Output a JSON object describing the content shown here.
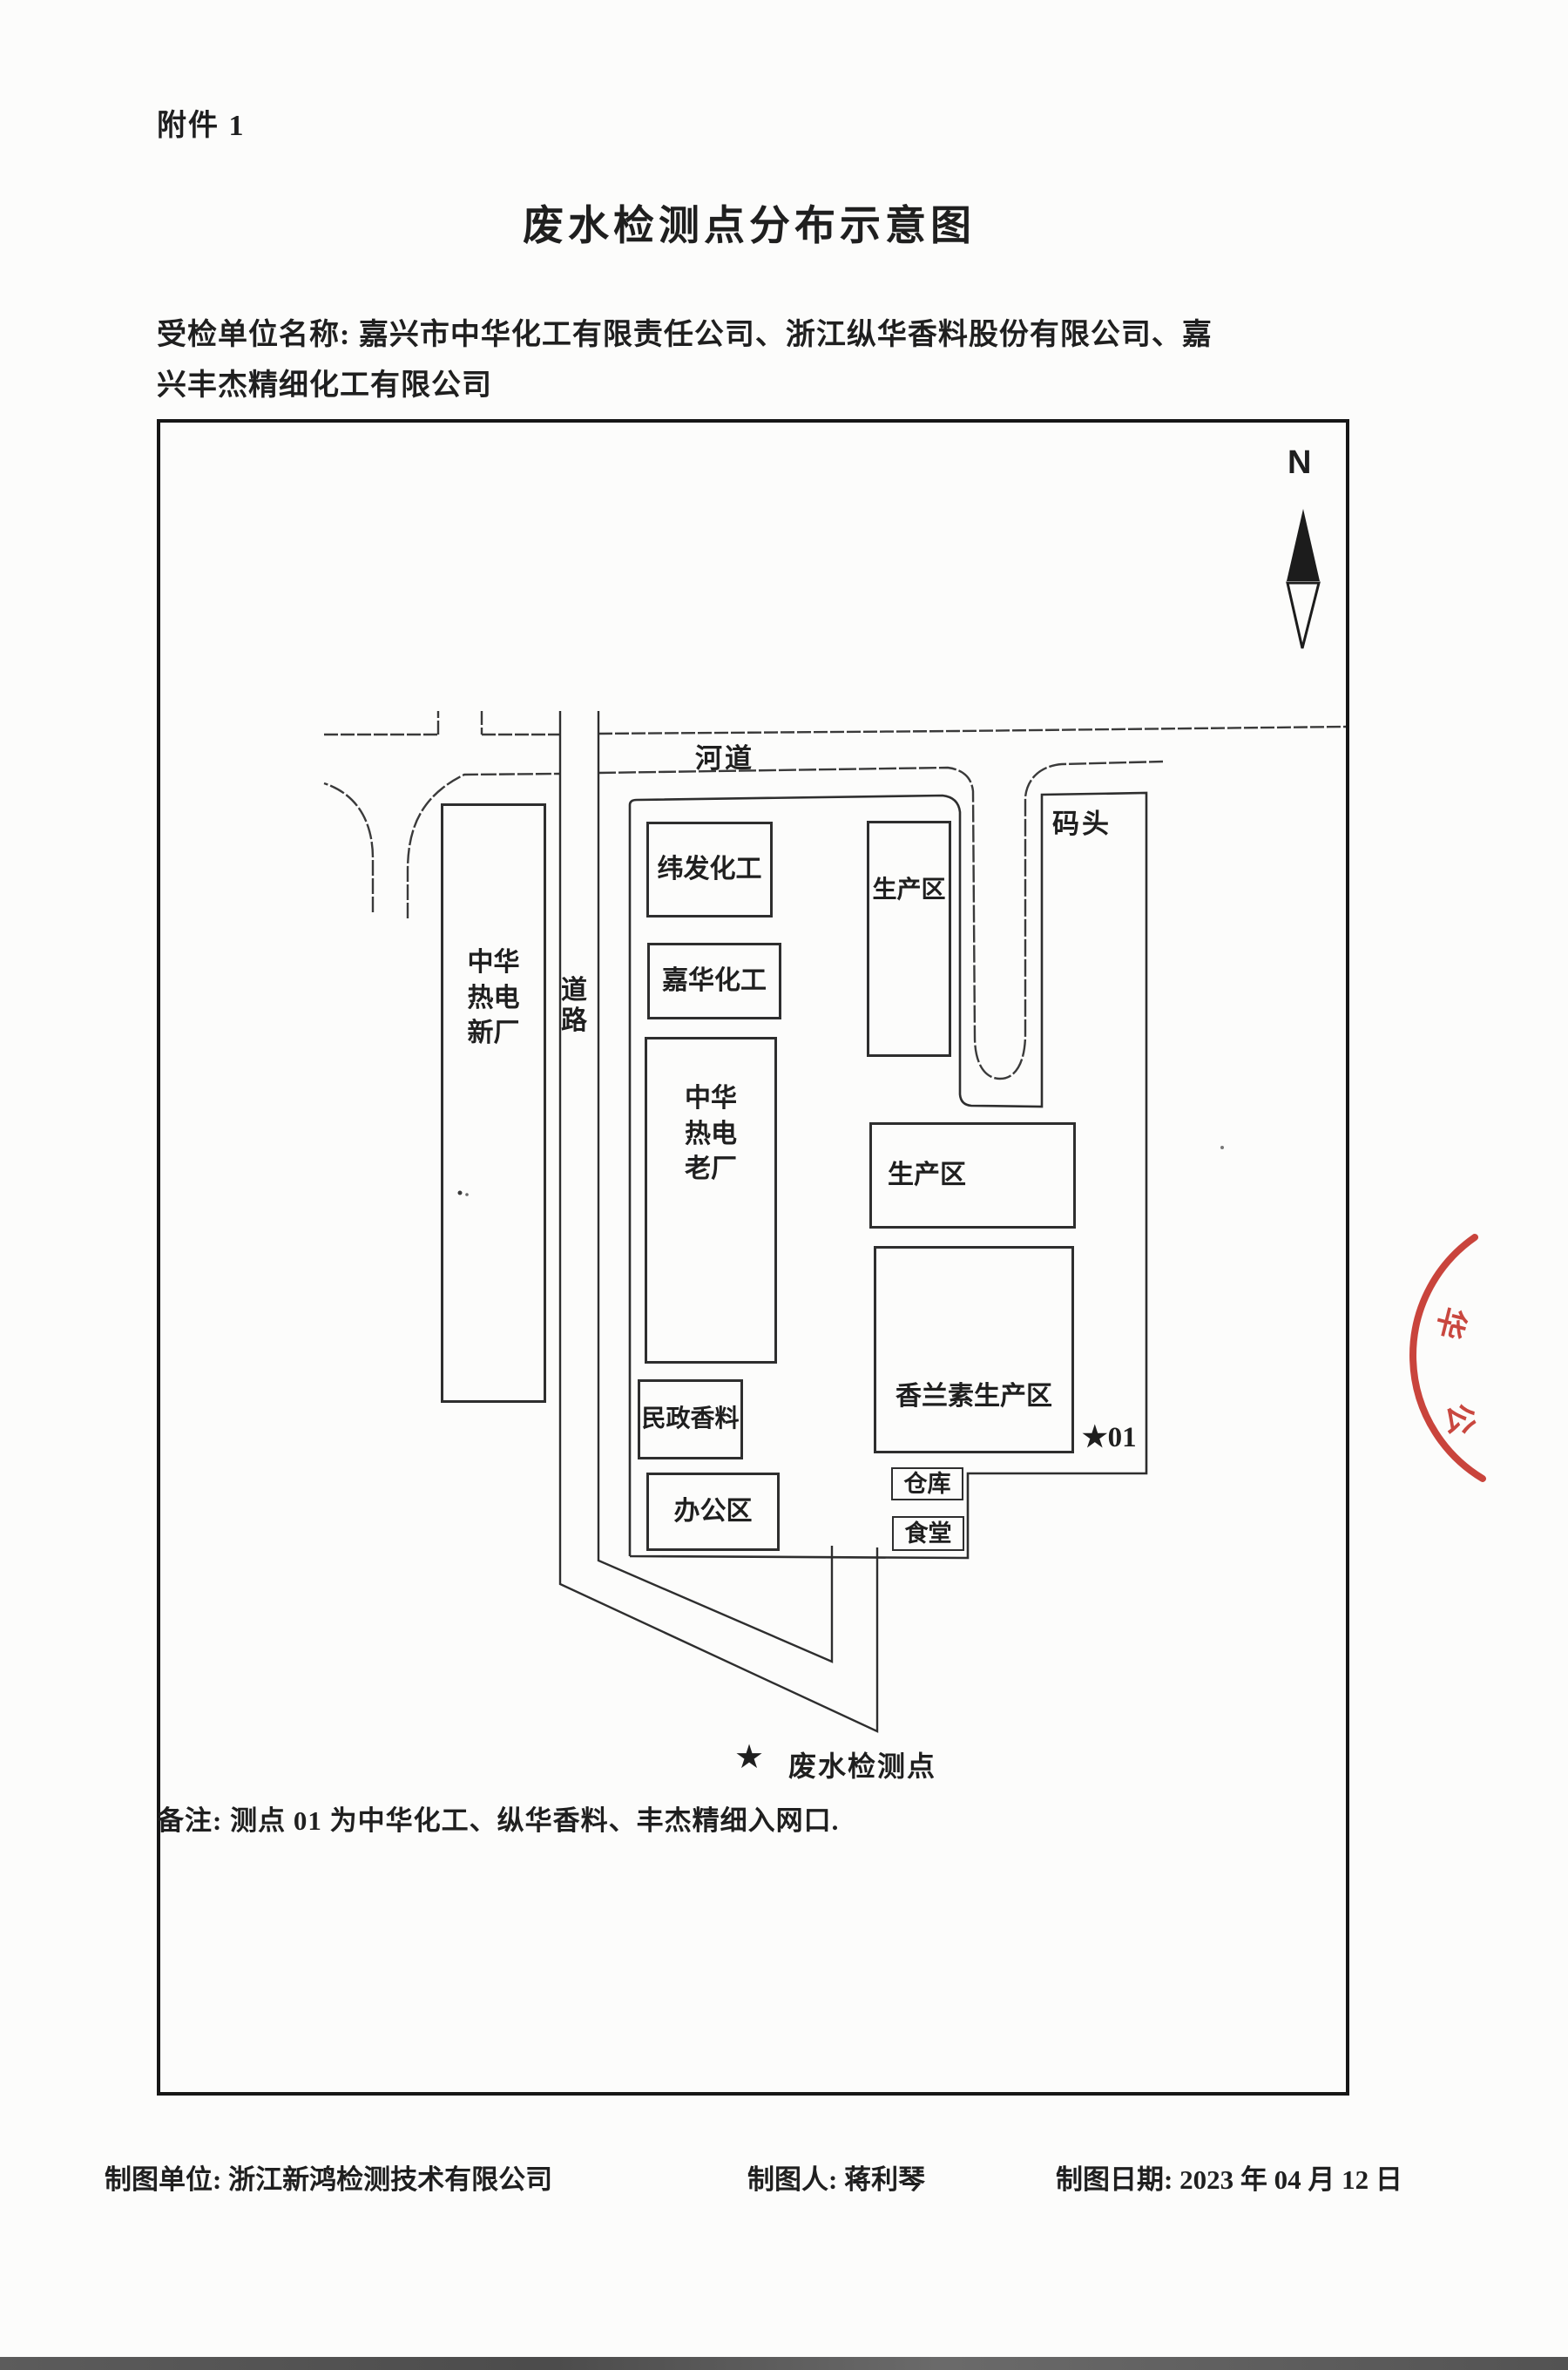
{
  "page": {
    "attachment_label": "附件 1",
    "title": "废水检测点分布示意图",
    "inspected_units_line1": "受检单位名称: 嘉兴市中华化工有限责任公司、浙江纵华香料股份有限公司、嘉",
    "inspected_units_line2": "兴丰杰精细化工有限公司"
  },
  "map": {
    "north_label": "N",
    "river_label": "河道",
    "dock_label": "码头",
    "road_label": "道路",
    "buildings": {
      "xinchang": "中华热电新厂",
      "weifa": "纬发化工",
      "jiahua": "嘉华化工",
      "laochang": "中华热电老厂",
      "minzheng": "民政香料",
      "bangong": "办公区",
      "shengchanqu_north": "生产区",
      "shengchanqu_mid": "生产区",
      "xianglansu": "香兰素生产区",
      "cangku": "仓库",
      "shitang": "食堂"
    },
    "monitoring_point": "★01",
    "legend": {
      "symbol": "★",
      "label": "废水检测点"
    },
    "note": "备注: 测点 01 为中华化工、纵华香料、丰杰精细入网口."
  },
  "footer": {
    "unit": "制图单位: 浙江新鸿检测技术有限公司",
    "drafter": "制图人: 蒋利琴",
    "date": "制图日期: 2023 年 04 月 12 日"
  },
  "stamp": {
    "glyphs": [
      "华",
      "公"
    ]
  },
  "colors": {
    "ink": "#1f1f1f",
    "line": "#2e2e2e",
    "stamp_red": "#c4342b",
    "paper": "#fcfcfb"
  }
}
